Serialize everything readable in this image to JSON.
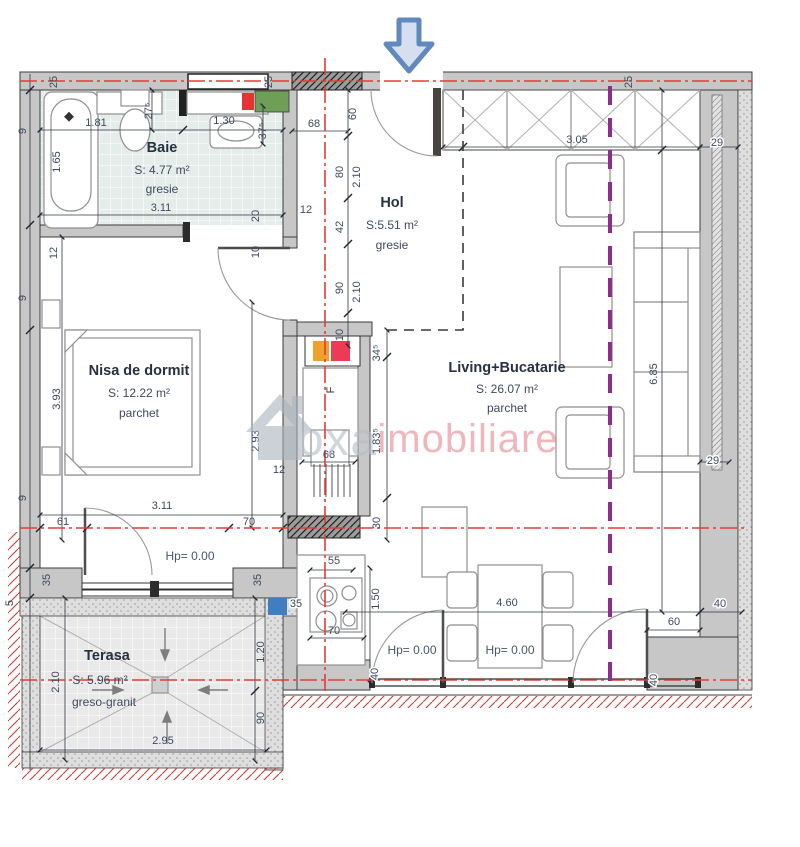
{
  "rooms": {
    "baie": {
      "name": "Baie",
      "area": "S: 4.77 m²",
      "floor": "gresie"
    },
    "hol": {
      "name": "Hol",
      "area": "S:5.51 m²",
      "floor": "gresie"
    },
    "nisa": {
      "name": "Nisa de dormit",
      "area": "S: 12.22 m²",
      "floor": "parchet"
    },
    "living": {
      "name": "Living+Bucatarie",
      "area": "S: 26.07 m²",
      "floor": "parchet"
    },
    "terasa": {
      "name": "Terasa",
      "area": "S: 5.96 m²",
      "floor": "greso-granit"
    }
  },
  "levels": {
    "hp_nisa": "Hp= 0.00",
    "hp_liv1": "Hp= 0.00",
    "hp_liv2": "Hp= 0.00"
  },
  "shaft": {
    "f_label": "F"
  },
  "watermark": {
    "gray": "oxa",
    "pink": "imobiliare"
  },
  "colors": {
    "axis_red": "#e63b35",
    "section_purple": "#8e2d8e",
    "arrow_blue": "#6189bd",
    "accent_orange": "#f0a02c",
    "accent_red": "#ef3a56",
    "accent_green": "#6f9e57",
    "accent_blue": "#3f7fc1",
    "bath_tile": "#e4edea",
    "wall_gray": "#c7c7c7"
  },
  "dims": {
    "t25a": "25",
    "t25b": "25",
    "t25c": "25",
    "b181": "1.81",
    "b275": "27⁵",
    "b130": "1.30",
    "b375": "37⁵",
    "b165": "1.65",
    "b311": "3.11",
    "b12": "12",
    "b20": "20",
    "b10": "10",
    "h68": "68",
    "h60": "60",
    "h80": "80",
    "h210a": "2.10",
    "h42": "42",
    "h90": "90",
    "h210b": "2.10",
    "h10": "10",
    "w305": "3.05",
    "r29a": "29",
    "r29b": "29",
    "r685": "6.85",
    "l9a": "9",
    "l12": "12",
    "l9b": "9",
    "l9c": "9",
    "l5": "5",
    "n393": "3.93",
    "n293": "2.93",
    "n311": "3.11",
    "n61": "61",
    "n70": "70",
    "s345": "34⁵",
    "s1835": "1.83⁵",
    "s30": "30",
    "s68": "68",
    "s12": "12",
    "k55": "55",
    "k150": "1.50",
    "k70": "70",
    "k35": "35",
    "v460": "4.60",
    "v40a": "40",
    "v60": "60",
    "v40b": "40",
    "v40c": "40",
    "ta35a": "35",
    "ta35b": "35",
    "ta210": "2.10",
    "ta120": "1.20",
    "ta90": "90",
    "ta295": "2.95"
  }
}
